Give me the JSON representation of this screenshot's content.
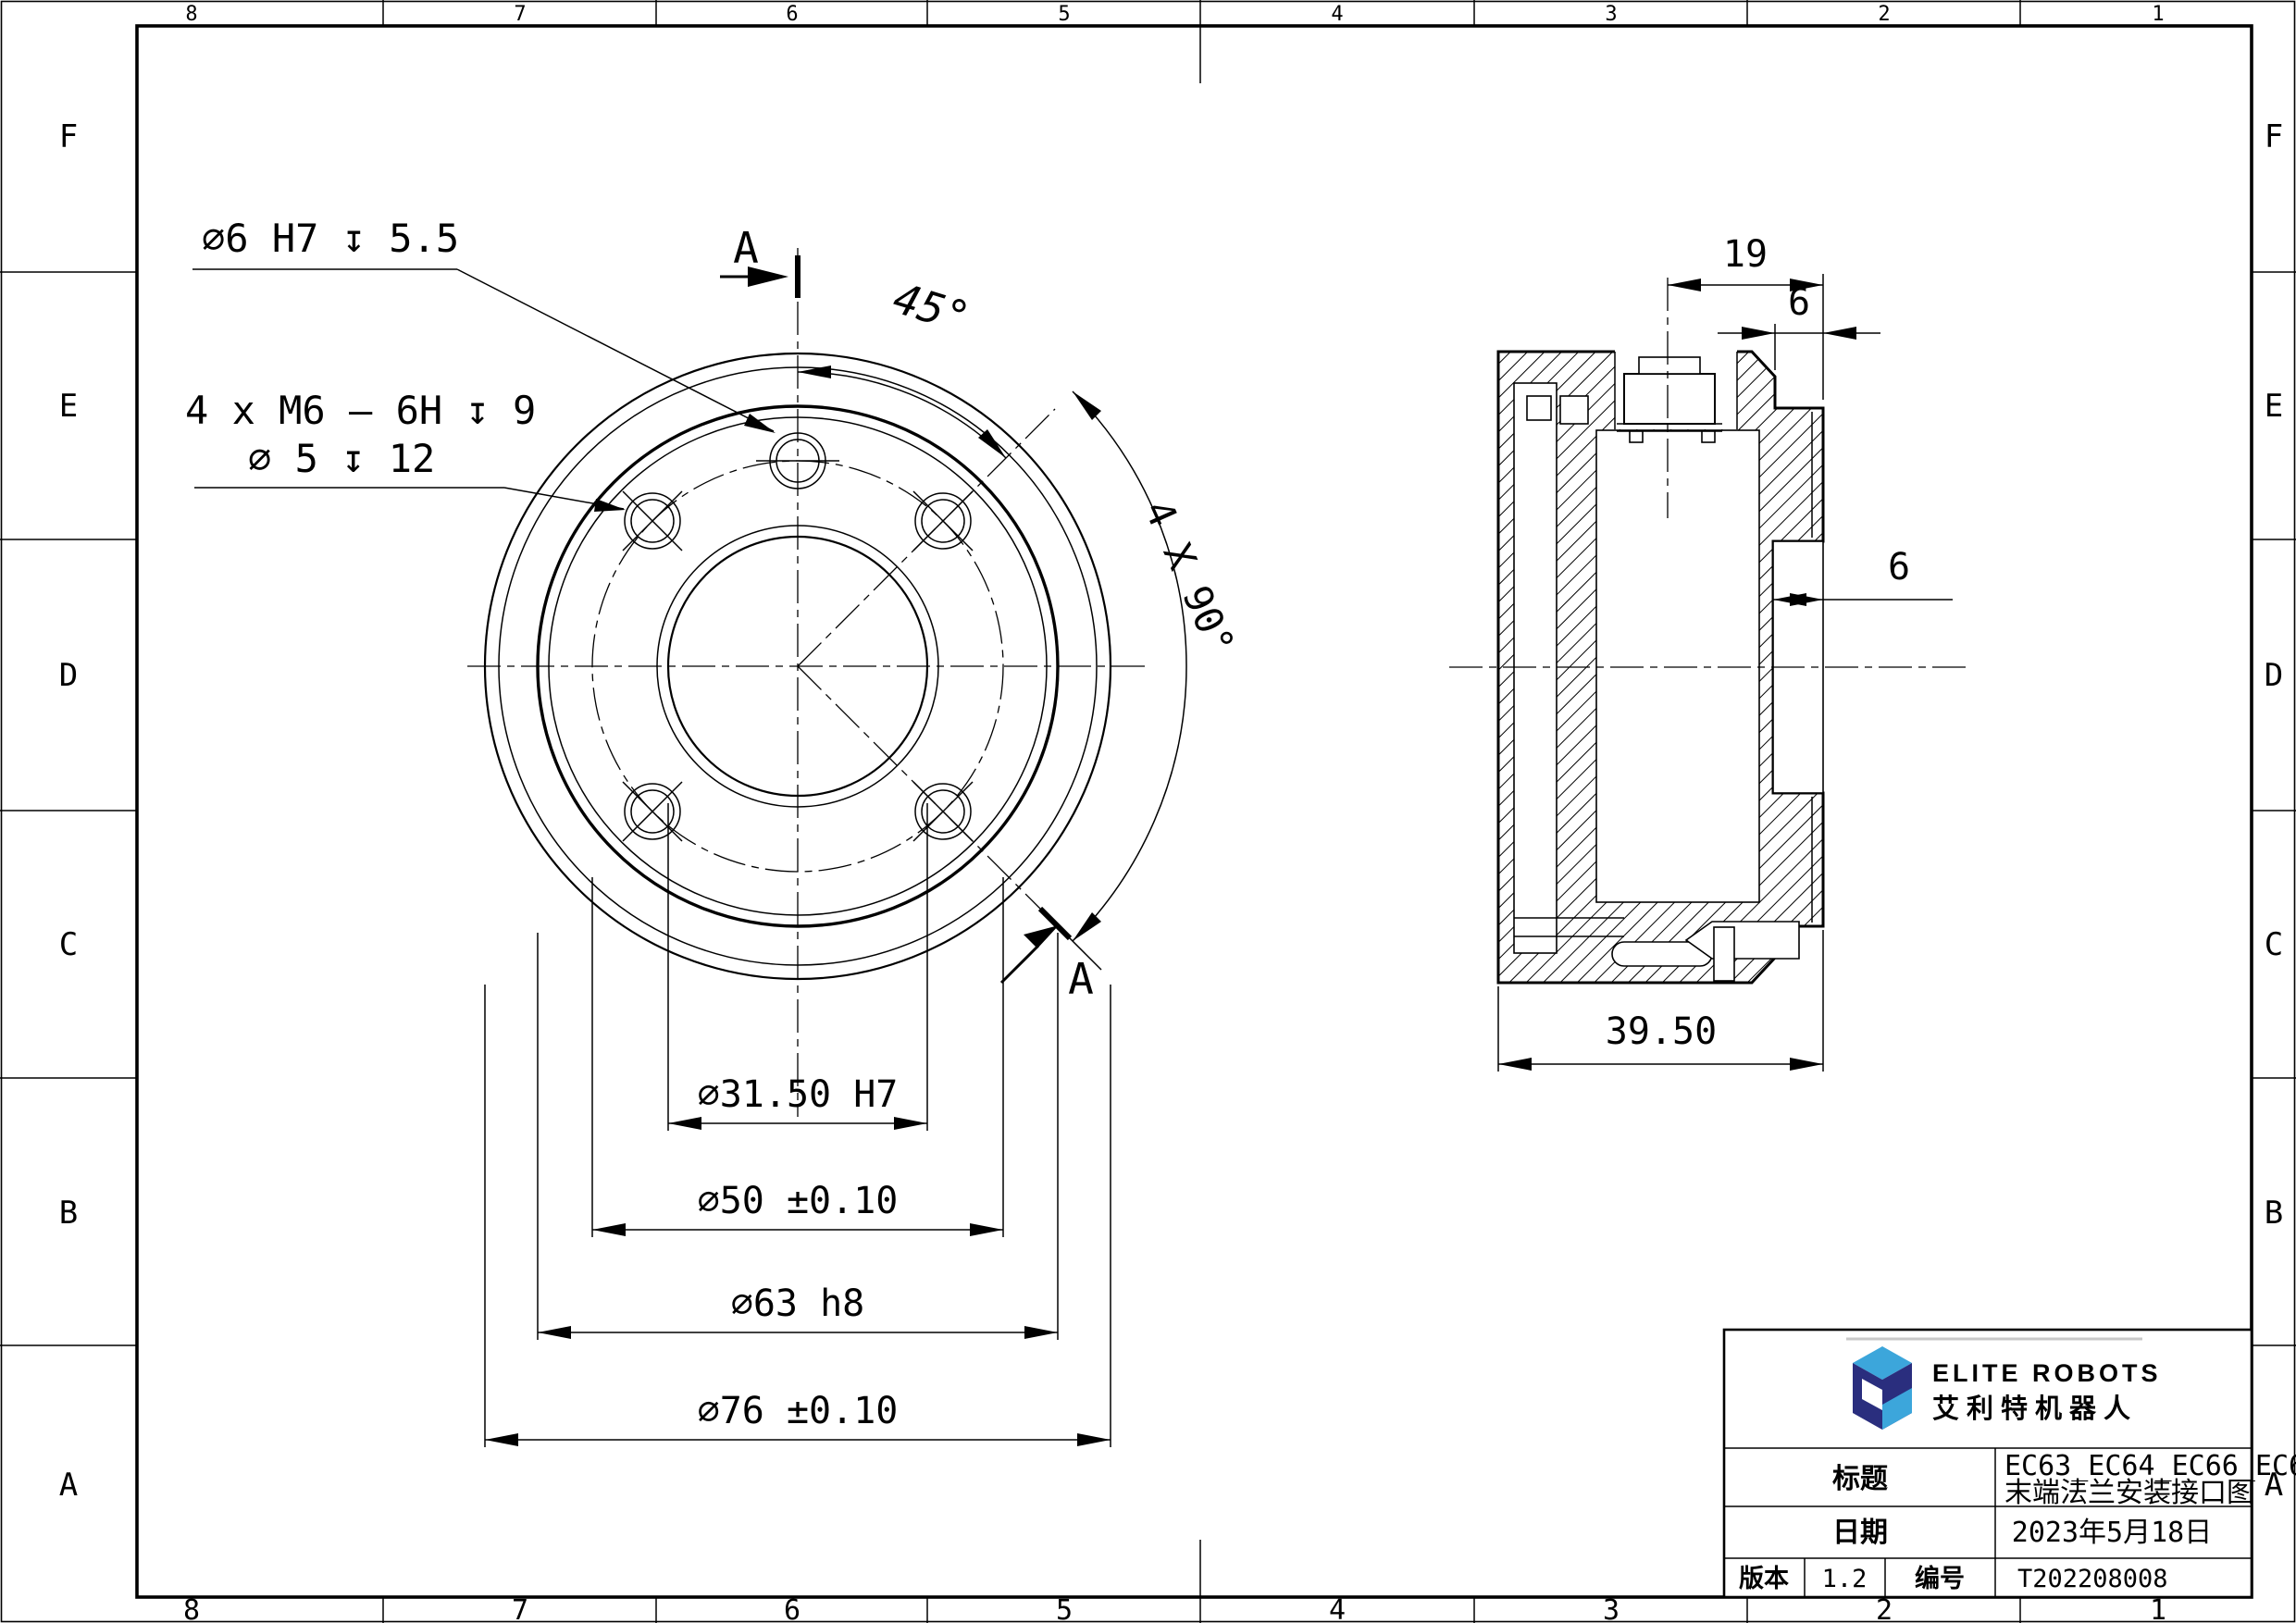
{
  "page": {
    "background": "#ffffff",
    "line_color": "#000000"
  },
  "border": {
    "columns": [
      "8",
      "7",
      "6",
      "5",
      "4",
      "3",
      "2",
      "1"
    ],
    "rows": [
      "F",
      "E",
      "D",
      "C",
      "B",
      "A"
    ]
  },
  "front_view": {
    "label_hole_top": "∅6 H7 ↧ 5.5",
    "label_holes_line1": "4 x M6 — 6H ↧ 9",
    "label_holes_line2": "∅ 5 ↧ 12",
    "angle_45": "45°",
    "angle_pattern": "4 X 90°",
    "section_label": "A",
    "dims": [
      "∅31.50 H7",
      "∅50 ±0.10",
      "∅63 h8",
      "∅76 ±0.10"
    ]
  },
  "section_view": {
    "dim_connector_offset": "19",
    "dim_flange_thickness": "6",
    "dim_recess_depth": "6",
    "dim_total_depth": "39.50"
  },
  "title_block": {
    "brand_en": "ELITE ROBOTS",
    "brand_cn": "艾利特机器人",
    "logo_navy": "#2A2E7E",
    "logo_sky": "#3CA6DB",
    "title_label": "标题",
    "title_value_line1": "EC63_EC64_EC66_EC68",
    "title_value_line2": "末端法兰安装接口图",
    "date_label": "日期",
    "date_value": "2023年5月18日",
    "version_label": "版本",
    "version_value": "1.2",
    "number_label": "编号",
    "number_value": "T202208008"
  }
}
